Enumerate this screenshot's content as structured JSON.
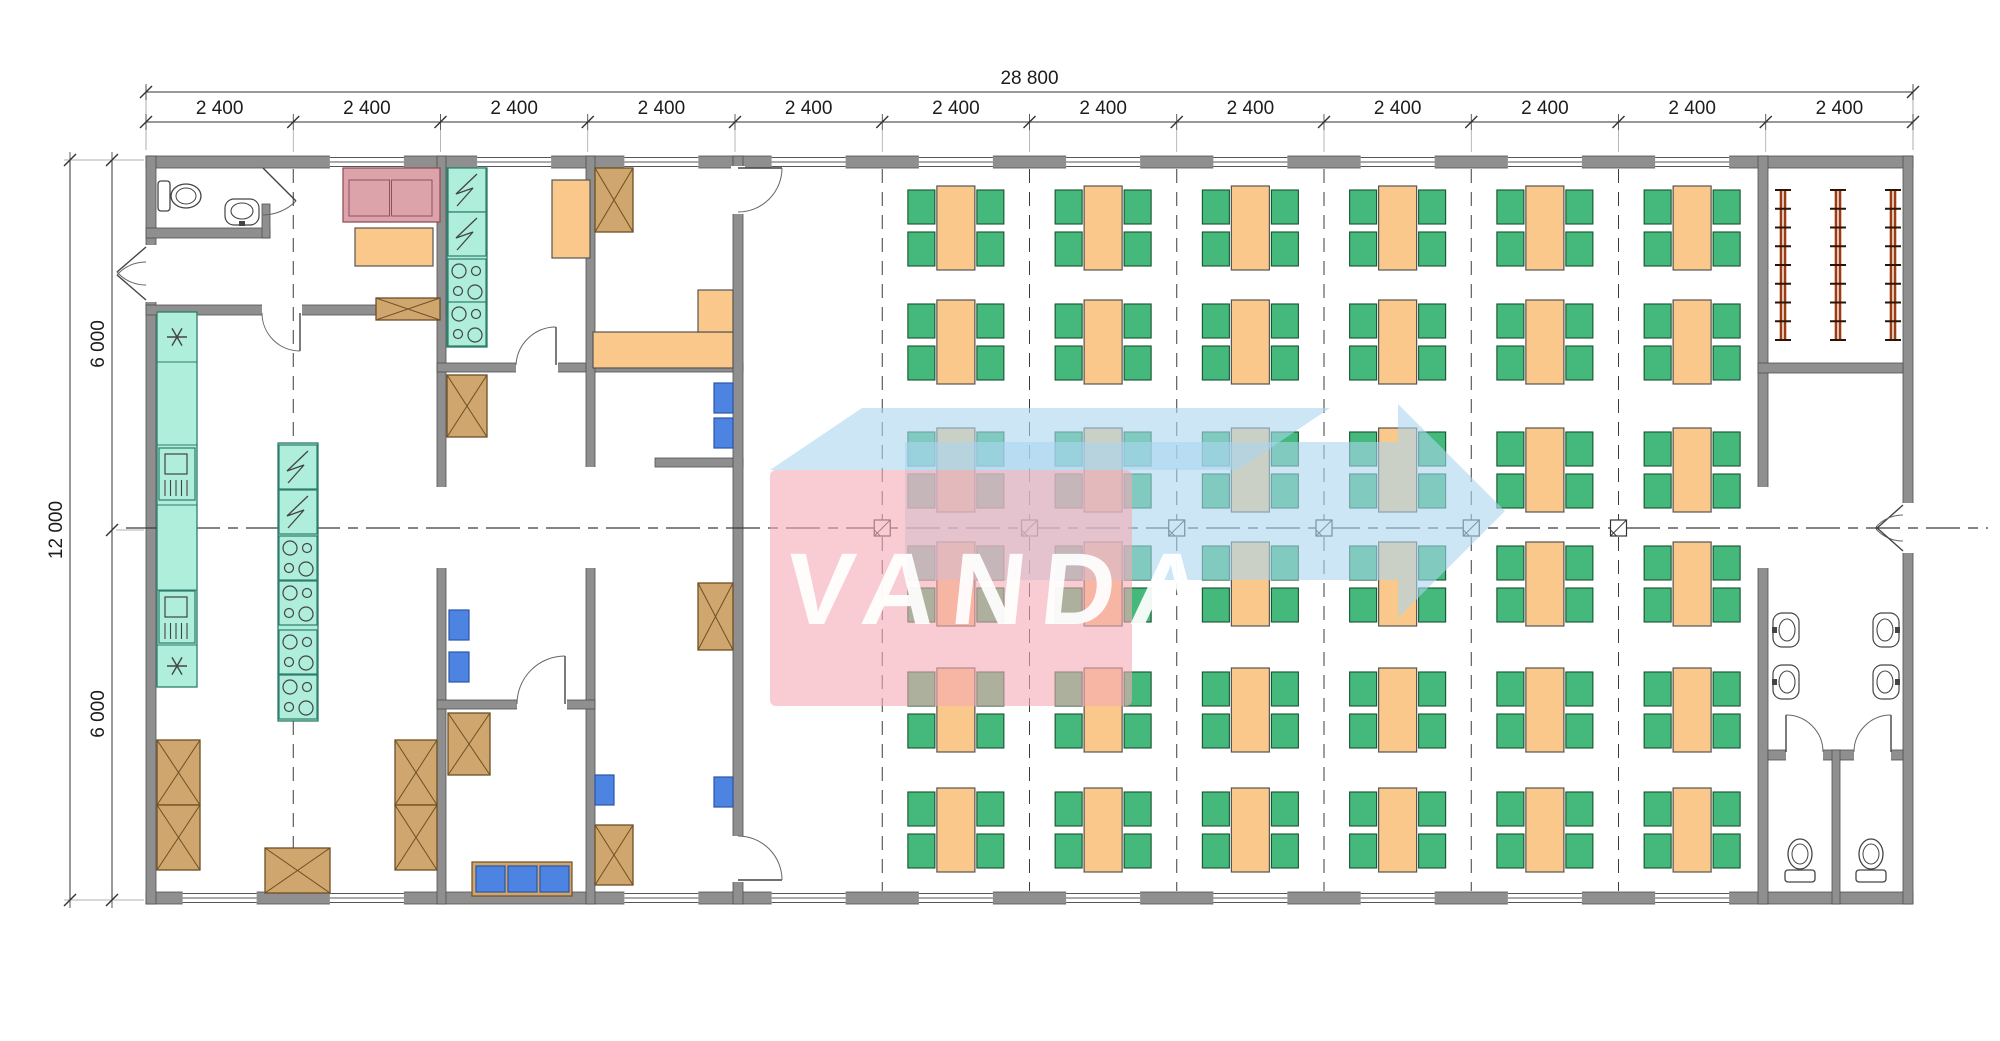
{
  "watermark": {
    "text": "VANDA",
    "pink": "rgba(243,170,180,0.60)",
    "blue": "rgba(170,214,238,0.60)",
    "text_color": "rgba(255,255,255,0.93)"
  },
  "dims": {
    "total_width_label": "28 800",
    "total_height_label": "12 000",
    "width_segment_labels": [
      "2 400",
      "2 400",
      "2 400",
      "2 400",
      "2 400",
      "2 400",
      "2 400",
      "2 400",
      "2 400",
      "2 400",
      "2 400",
      "2 400"
    ],
    "height_segment_labels": [
      "6 000",
      "6 000"
    ]
  },
  "colors": {
    "wall": "#8f8f8f",
    "wall_stroke": "#4f4f4f",
    "table": "#f9c88a",
    "table_stroke": "#555555",
    "chair": "#45b87c",
    "chair_stroke": "#14532d",
    "teal": "#aeeedb",
    "teal_stroke": "#2f7d6b",
    "cabinet": "#cfa66d",
    "cabinet_stroke": "#6e4f26",
    "blue": "#4d84e2",
    "blue_stroke": "#2a55a8",
    "sofa": "#dca3ab",
    "sofa_stroke": "#8f525c",
    "rack": "#9c3c12",
    "rack_tick": "#2d1405",
    "dash": "#3c3c3c",
    "dim_line": "#333333",
    "ext_line": "#999999",
    "fixture_stroke": "#444444"
  },
  "plan": {
    "left": 146,
    "right": 1913,
    "top": 160,
    "bottom": 900,
    "bays": 12,
    "centerline_y": 528,
    "kitchen_dash_boundary": 1,
    "hall_dash_boundaries": [
      5,
      6,
      7,
      8,
      9,
      10
    ],
    "column_marker_boundaries": [
      5,
      6,
      7,
      8,
      9,
      10
    ],
    "walls": [
      [
        146,
        156,
        1767,
        12
      ],
      [
        146,
        892,
        1767,
        12
      ],
      [
        146,
        156,
        10,
        748
      ],
      [
        1903,
        156,
        10,
        748
      ],
      [
        146,
        228,
        124,
        10
      ],
      [
        262,
        204,
        8,
        34
      ],
      [
        146,
        305,
        300,
        10
      ],
      [
        437,
        156,
        9,
        748
      ],
      [
        437,
        363,
        159,
        9
      ],
      [
        590,
        363,
        153,
        9
      ],
      [
        586,
        156,
        9,
        748
      ],
      [
        655,
        458,
        88,
        9
      ],
      [
        733,
        156,
        10,
        748
      ],
      [
        437,
        700,
        158,
        9
      ],
      [
        1758,
        156,
        10,
        748
      ],
      [
        1758,
        363,
        145,
        10
      ],
      [
        1768,
        750,
        135,
        10
      ],
      [
        1832,
        750,
        8,
        154
      ]
    ],
    "gaps": [
      [
        144,
        245,
        14,
        57
      ],
      [
        1901,
        503,
        14,
        50
      ],
      [
        262,
        303,
        40,
        14
      ],
      [
        516,
        361,
        42,
        13
      ],
      [
        517,
        698,
        50,
        13
      ],
      [
        731,
        166,
        14,
        48
      ],
      [
        731,
        836,
        14,
        46
      ],
      [
        435,
        487,
        13,
        81
      ],
      [
        584,
        467,
        13,
        101
      ],
      [
        1756,
        487,
        14,
        81
      ],
      [
        1786,
        748,
        37,
        14
      ],
      [
        1854,
        748,
        37,
        14
      ]
    ],
    "doors": [
      {
        "leaf": [
          146,
          247,
          117,
          272
        ],
        "arc": "M117,272 A38,38 0 0 0 146,285"
      },
      {
        "leaf": [
          146,
          300,
          117,
          275
        ],
        "arc": "M117,275 A38,38 0 0 1 146,262"
      },
      {
        "leaf": [
          1903,
          505,
          1876,
          529
        ],
        "arc": "M1903,541 A36,36 0 0 1 1876,529"
      },
      {
        "leaf": [
          1903,
          551,
          1876,
          527
        ],
        "arc": "M1903,515 A36,36 0 0 0 1876,527"
      },
      {
        "leaf": [
          263,
          168,
          296,
          201
        ],
        "arc": "M263,215 A47,47 0 0 0 296,201"
      },
      {
        "leaf": [
          300,
          313,
          300,
          351
        ],
        "arc": "M262,313 A38,38 0 0 0 300,351"
      },
      {
        "leaf": [
          556,
          365,
          556,
          327
        ],
        "arc": "M516,365 A40,40 0 0 1 556,327"
      },
      {
        "leaf": [
          565,
          704,
          565,
          656
        ],
        "arc": "M517,704 A48,48 0 0 1 565,656"
      },
      {
        "leaf": [
          738,
          168,
          782,
          168
        ],
        "arc": "M738,212 A44,44 0 0 0 782,168"
      },
      {
        "leaf": [
          738,
          880,
          782,
          880
        ],
        "arc": "M738,836 A44,44 0 0 1 782,880"
      },
      {
        "leaf": [
          1786,
          752,
          1786,
          715
        ],
        "arc": "M1823,752 A37,37 0 0 0 1786,715"
      },
      {
        "leaf": [
          1891,
          752,
          1891,
          715
        ],
        "arc": "M1854,752 A37,37 0 0 1 1891,715"
      }
    ],
    "windows": {
      "width": 74,
      "top_bays": [
        2,
        3,
        4,
        5,
        6,
        7,
        8,
        9,
        10,
        11
      ],
      "bottom_bays": [
        1,
        2,
        4,
        5,
        6,
        7,
        8,
        9,
        10,
        11
      ]
    }
  },
  "dining": {
    "table_bays": [
      6,
      7,
      8,
      9,
      10,
      11
    ],
    "row_centers_y": [
      228,
      342,
      470,
      584,
      710,
      830
    ],
    "table_w": 38,
    "table_h": 84,
    "chair_w": 27,
    "chair_h": 34,
    "columns": 6,
    "rows": 6,
    "table_count": 36,
    "chairs_per_table": 4,
    "total_seats": 144
  },
  "furniture": {
    "x_cabinets": [
      [
        157,
        740,
        43,
        65
      ],
      [
        157,
        805,
        43,
        65
      ],
      [
        265,
        848,
        65,
        45
      ],
      [
        395,
        740,
        42,
        65
      ],
      [
        395,
        805,
        42,
        65
      ],
      [
        448,
        713,
        42,
        62
      ],
      [
        447,
        375,
        40,
        62
      ],
      [
        595,
        168,
        38,
        64
      ],
      [
        595,
        825,
        38,
        60
      ],
      [
        698,
        583,
        35,
        67
      ],
      [
        376,
        298,
        64,
        22
      ]
    ],
    "blue_chairs": [
      [
        449,
        610,
        20,
        30
      ],
      [
        449,
        652,
        20,
        30
      ],
      [
        595,
        775,
        19,
        30
      ],
      [
        714,
        777,
        19,
        30
      ],
      [
        714,
        383,
        19,
        30
      ],
      [
        714,
        418,
        19,
        30
      ]
    ],
    "bench": {
      "base": [
        472,
        862,
        100,
        34
      ],
      "seats": [
        [
          476,
          866,
          29,
          26
        ],
        [
          508,
          866,
          29,
          26
        ],
        [
          540,
          866,
          29,
          26
        ]
      ]
    },
    "sofa": [
      343,
      168,
      97,
      54
    ],
    "coffee_table": [
      355,
      228,
      78,
      38
    ],
    "prep_desk": [
      552,
      180,
      38,
      78
    ],
    "l_counter": [
      [
        593,
        332,
        140,
        36
      ],
      [
        698,
        290,
        35,
        42
      ]
    ],
    "left_counter": {
      "base": [
        157,
        312,
        40,
        375
      ],
      "sinks": [
        [
          177,
          337
        ],
        [
          177,
          666
        ]
      ],
      "dishwashers": [
        [
          177,
          474
        ],
        [
          177,
          617
        ]
      ]
    },
    "island": {
      "base": [
        278,
        443,
        40,
        278
      ],
      "fridges": [
        [
          298,
          467
        ],
        [
          298,
          512
        ]
      ],
      "stoves": [
        [
          298,
          558
        ],
        [
          298,
          603
        ],
        [
          298,
          652
        ],
        [
          298,
          697
        ]
      ]
    },
    "prep_column": {
      "base": [
        447,
        168,
        40,
        179
      ],
      "fridges": [
        [
          467,
          190
        ],
        [
          467,
          234
        ]
      ],
      "stoves": [
        [
          467,
          281
        ],
        [
          467,
          324
        ]
      ]
    },
    "coat_racks": {
      "xs": [
        1783,
        1838,
        1893
      ],
      "y1": 190,
      "y2": 340,
      "hooks": 9
    },
    "washbasins": [
      [
        242,
        212,
        0
      ],
      [
        1786,
        630,
        90
      ],
      [
        1786,
        682,
        90
      ],
      [
        1886,
        630,
        -90
      ],
      [
        1886,
        682,
        -90
      ]
    ],
    "toilets": [
      [
        178,
        196,
        90
      ],
      [
        1800,
        862,
        0
      ],
      [
        1871,
        862,
        0
      ]
    ]
  },
  "icons": {
    "toilet": "toilet-icon",
    "washbasin": "washbasin-icon",
    "sink": "sink-star-icon",
    "refrigerator": "fridge-lightning-icon",
    "stove": "stove-4burner-icon",
    "dishwasher": "dishwasher-icon",
    "coat_rack": "coat-rack-icon",
    "column_marker": "column-marker-icon"
  }
}
